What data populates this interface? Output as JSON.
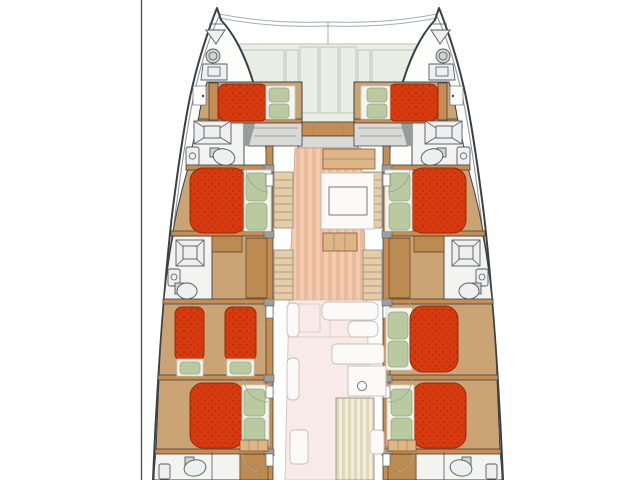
{
  "diagram": {
    "type": "boat-floor-plan",
    "subject": "sailing-catamaran-deck-layout-top-view",
    "orientation": "bow-up",
    "cabins_with_double_beds": 7,
    "single_beds": 2,
    "bathrooms_visible": 6,
    "areas": [
      "foredeck-with-sunpads",
      "port-forward-cabin",
      "starboard-forward-cabin",
      "port-forward-bathroom",
      "starboard-forward-bathroom",
      "port-mid-cabin",
      "starboard-mid-cabin",
      "port-mid-bathroom",
      "starboard-mid-bathroom",
      "port-twin-cabin",
      "starboard-guest-cabin",
      "port-aft-cabin",
      "starboard-aft-cabin",
      "port-aft-bathroom",
      "starboard-aft-bathroom",
      "salon-galley",
      "cockpit"
    ]
  },
  "colors": {
    "background": "#ffffff",
    "divider": "#4a4a4a",
    "hull-line": "#3a4045",
    "hull-fill": "#fdfdfc",
    "deck-edge": "#8b9094",
    "cabin-floor": "#cba476",
    "bath-floor": "#f3f3ef",
    "landing": "#d9d9d5",
    "wood-trim": "#c68d52",
    "wood-light": "#e0b584",
    "wood-dark": "#6e4a26",
    "bed-red": "#d63a0e",
    "bed-red-dark": "#b82f06",
    "bed-outline": "#9e2806",
    "sheet": "#f4f4f1",
    "pillow": "#b9caa1",
    "pillow-line": "#90a67c",
    "fixture-line": "#555a5e",
    "fixture-fill": "#eef0ef",
    "gray-metal": "#cfd3d3",
    "steps-wood": "#e6cda6",
    "salon-a": "#f2cbb0",
    "salon-b": "#e9ba9b",
    "cockpit": "#f8ebe7",
    "cockpit-line": "#ddcdc7",
    "white-furn": "#fcfaf8",
    "furn-line": "#c5bdb6",
    "deck-green": "#e9efe4",
    "deck-line": "#b7c3b3",
    "hatch-bg": "#d8a566",
    "hatch-ln": "#8a5a2a",
    "table-bg": "#f2ecda",
    "table-st": "#e1d7ba",
    "arc": "#a0a09a"
  }
}
